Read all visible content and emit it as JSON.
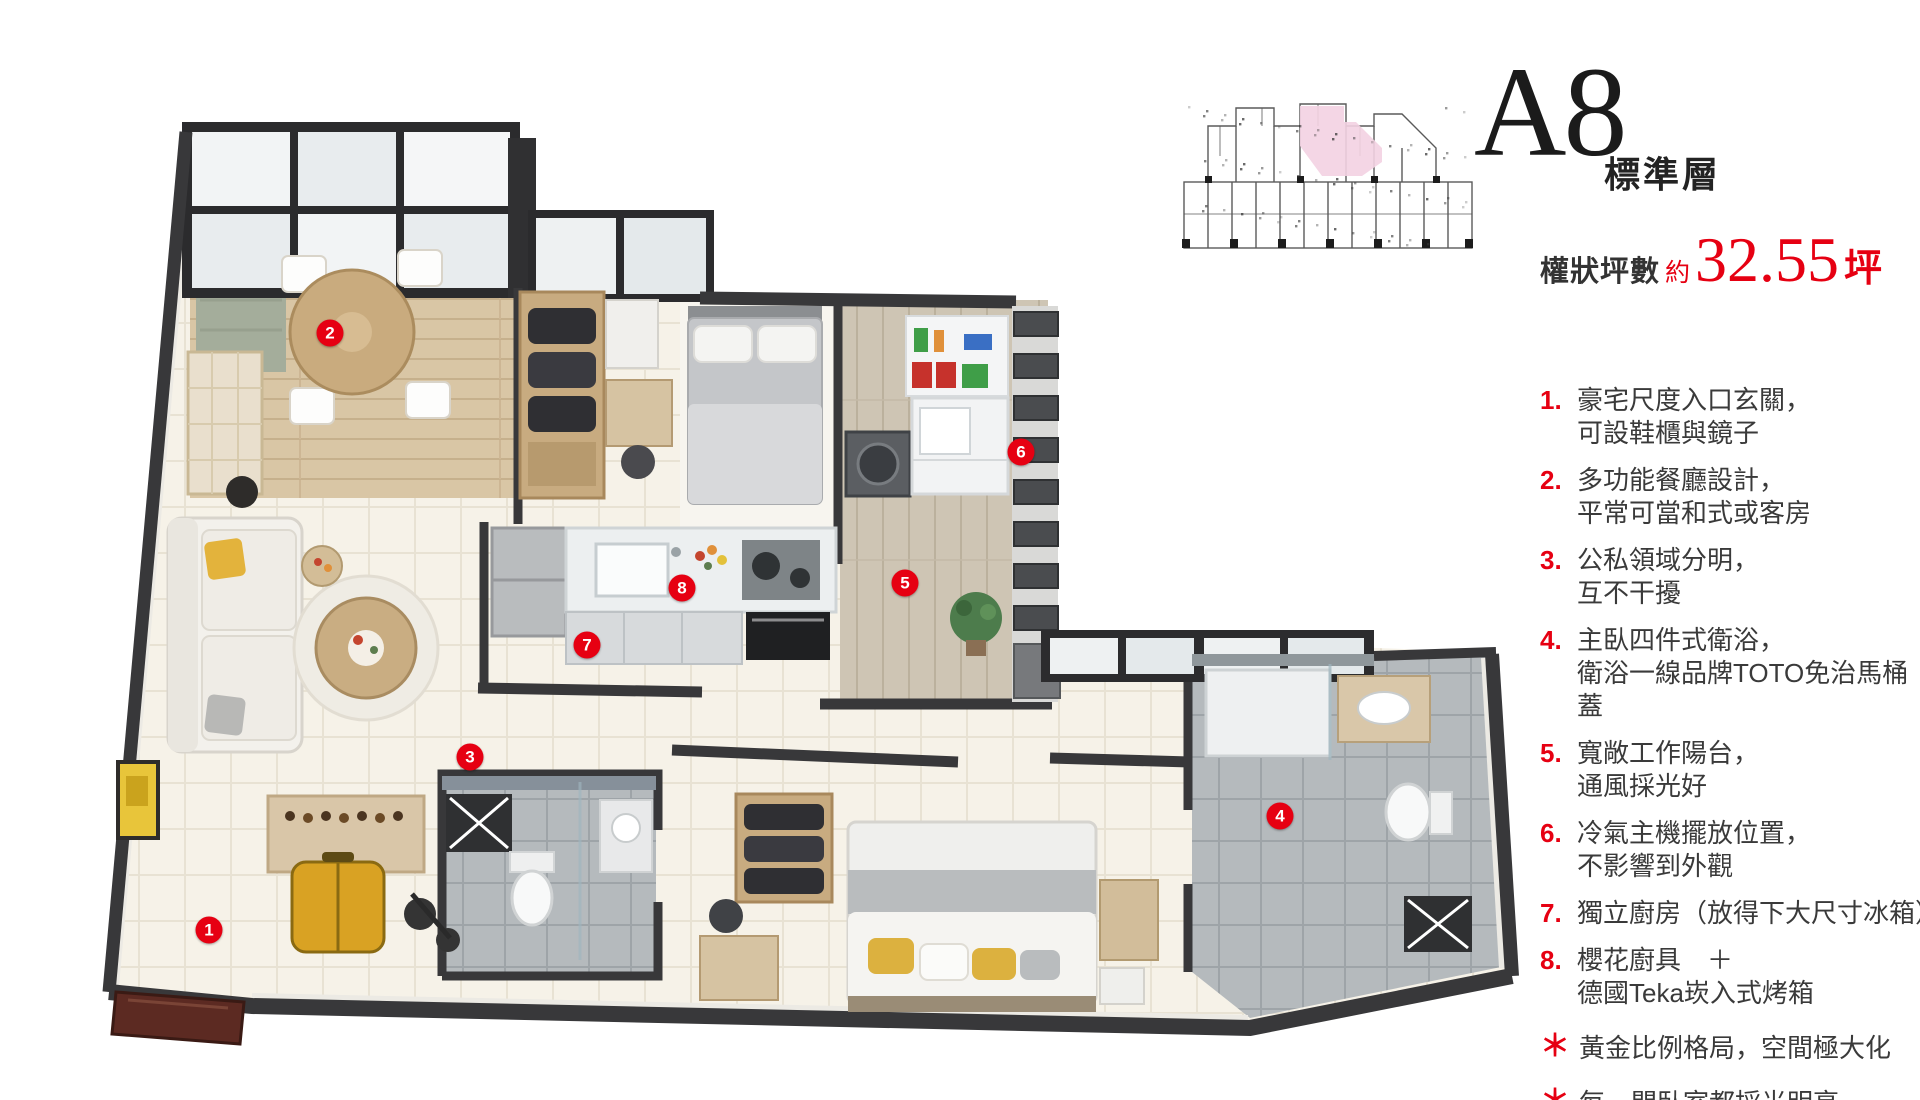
{
  "colors": {
    "red": "#e60012",
    "text": "#3a3a3a",
    "wall": "#38383a",
    "keyplan_highlight": "#f3d2e2"
  },
  "header": {
    "unit": "A8",
    "floor_type": "標準層",
    "area_label": "權狀坪數",
    "area_approx": "約",
    "area_value": "32.55",
    "area_unit": "坪"
  },
  "features": [
    {
      "num": "1.",
      "star": false,
      "lines": [
        "豪宅尺度入口玄關，",
        "可設鞋櫃與鏡子"
      ]
    },
    {
      "num": "2.",
      "star": false,
      "lines": [
        "多功能餐廳設計，",
        "平常可當和式或客房"
      ]
    },
    {
      "num": "3.",
      "star": false,
      "lines": [
        "公私領域分明，",
        "互不干擾"
      ]
    },
    {
      "num": "4.",
      "star": false,
      "lines": [
        "主臥四件式衛浴，",
        "衛浴一線品牌TOTO免治馬桶蓋"
      ]
    },
    {
      "num": "5.",
      "star": false,
      "lines": [
        "寬敞工作陽台，",
        "通風採光好"
      ]
    },
    {
      "num": "6.",
      "star": false,
      "lines": [
        "冷氣主機擺放位置，",
        "不影響到外觀"
      ]
    },
    {
      "num": "7.",
      "star": false,
      "lines": [
        "獨立廚房（放得下大尺寸冰箱）"
      ]
    },
    {
      "num": "8.",
      "star": false,
      "lines": [
        "櫻花廚具　＋",
        "德國Teka崁入式烤箱"
      ]
    },
    {
      "num": "＊",
      "star": true,
      "lines": [
        "黃金比例格局，空間極大化"
      ]
    },
    {
      "num": "＊",
      "star": true,
      "lines": [
        "每一間臥室都採光明亮"
      ]
    }
  ],
  "plan_markers": [
    {
      "n": "1",
      "x": 209,
      "y": 930
    },
    {
      "n": "2",
      "x": 330,
      "y": 333
    },
    {
      "n": "3",
      "x": 470,
      "y": 757
    },
    {
      "n": "4",
      "x": 1280,
      "y": 816
    },
    {
      "n": "5",
      "x": 905,
      "y": 583
    },
    {
      "n": "6",
      "x": 1021,
      "y": 452
    },
    {
      "n": "7",
      "x": 587,
      "y": 645
    },
    {
      "n": "8",
      "x": 682,
      "y": 588
    }
  ]
}
